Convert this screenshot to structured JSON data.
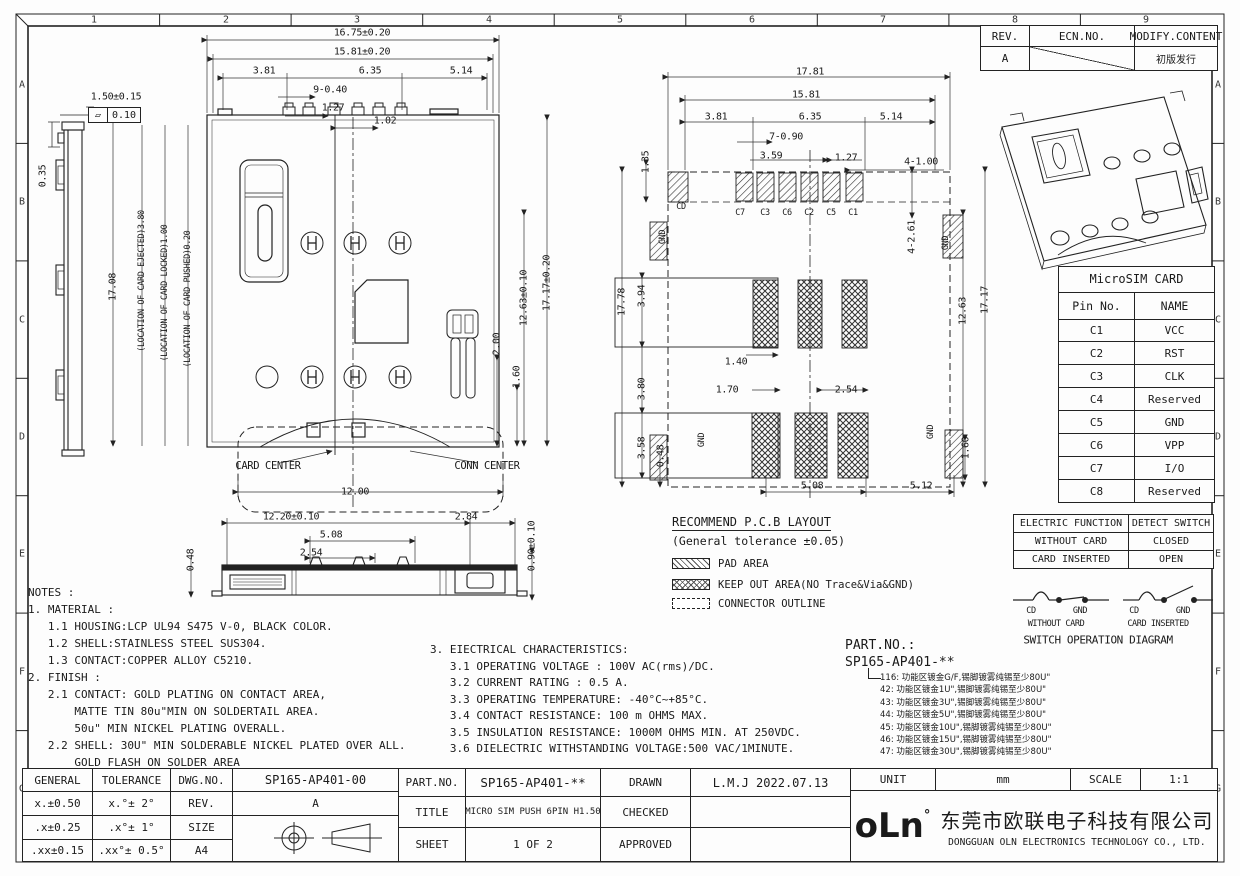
{
  "frame": {
    "columns": [
      "1",
      "2",
      "3",
      "4",
      "5",
      "6",
      "7",
      "8",
      "9"
    ],
    "rows": [
      "A",
      "B",
      "C",
      "D",
      "E",
      "F",
      "G"
    ]
  },
  "revision_table": {
    "rev_header": "REV.",
    "ecn_header": "ECN.NO.",
    "modify_header": "MODIFY.CONTENT",
    "rev": "A",
    "modify": "初版发行"
  },
  "dims": {
    "sv_d1": "1.50±0.15",
    "sv_flat": "0.10",
    "sv_d2": "0.35",
    "tv_w1": "16.75±0.20",
    "tv_w2": "15.81±0.20",
    "tv_w3": "3.81",
    "tv_w4": "6.35",
    "tv_w5": "5.14",
    "tv_pin": "9-0.40",
    "tv_p1": "1.27",
    "tv_p2": "1.02",
    "tv_h": "17.08",
    "tv_loc1": "(LOCATION OF CARD EJECTED)3.80",
    "tv_loc2": "(LOCATION OF CARD LOCKED)1.00",
    "tv_loc3": "(LOCATION OF CARD PUSHED)0.20",
    "tv_h1": "12.63±0.10",
    "tv_h2": "17.17±0.20",
    "tv_d200": "2.00",
    "tv_d160": "1.60",
    "tv_w6": "12.00",
    "cc": "CARD CENTER",
    "conn": "CONN CENTER",
    "bv_w1": "12.20±0.10",
    "bv_w2": "2.84",
    "bv_w3": "5.08",
    "bv_w4": "2.54",
    "bv_h1": "0.48",
    "bv_h2": "0.90±0.10",
    "pcb_w1": "17.81",
    "pcb_w2": "15.81",
    "pcb_w3": "3.81",
    "pcb_w4": "6.35",
    "pcb_w5": "5.14",
    "pcb_pin": "7-0.90",
    "pcb_d359": "3.59",
    "pcb_d127": "1.27",
    "pcb_d100": "4-1.00",
    "pcb_d135": "1.35",
    "pcb_cd": "CD",
    "pcb_c7": "C7",
    "pcb_c3": "C3",
    "pcb_c6": "C6",
    "pcb_c2": "C2",
    "pcb_c5": "C5",
    "pcb_c1": "C1",
    "pcb_gnd1": "GND",
    "pcb_gnd2": "GND",
    "pcb_gnd3": "GND",
    "pcb_gnd4": "GND",
    "pcb_d261": "4-2.61",
    "pcb_h1778": "17.78",
    "pcb_d394": "3.94",
    "pcb_d380": "3.80",
    "pcb_d358": "3.58",
    "pcb_d048": "0.48",
    "pcb_d140": "1.40",
    "pcb_d170": "1.70",
    "pcb_d254": "2.54",
    "pcb_d1263": "12.63",
    "pcb_d1717": "17.17",
    "pcb_d160": "1.60",
    "pcb_d508": "5.08",
    "pcb_d512": "5.12"
  },
  "pcb_legend": {
    "title": "RECOMMEND P.C.B LAYOUT",
    "subtitle": "(General tolerance ±0.05)",
    "pad": "PAD AREA",
    "keepout": "KEEP OUT AREA(NO Trace&Via&GND)",
    "outline": "CONNECTOR OUTLINE"
  },
  "sim_table": {
    "title": "MicroSIM CARD",
    "pin_header": "Pin No.",
    "name_header": "NAME",
    "rows": [
      [
        "C1",
        "VCC"
      ],
      [
        "C2",
        "RST"
      ],
      [
        "C3",
        "CLK"
      ],
      [
        "C4",
        "Reserved"
      ],
      [
        "C5",
        "GND"
      ],
      [
        "C6",
        "VPP"
      ],
      [
        "C7",
        "I/O"
      ],
      [
        "C8",
        "Reserved"
      ]
    ]
  },
  "switch_table": {
    "h1": "ELECTRIC FUNCTION",
    "h2": "DETECT SWITCH",
    "r1c1": "WITHOUT CARD",
    "r1c2": "CLOSED",
    "r2c1": "CARD INSERTED",
    "r2c2": "OPEN"
  },
  "switch_diagram": {
    "cd1": "CD",
    "gnd1": "GND",
    "cd2": "CD",
    "gnd2": "GND",
    "without": "WITHOUT CARD",
    "inserted": "CARD INSERTED",
    "title": "SWITCH OPERATION DIAGRAM"
  },
  "part_options": {
    "label": "PART.NO.:",
    "value": "SP165-AP401-**",
    "options": [
      "116: 功能区镀金G/F,锡脚镀雾纯锡至少80U\"",
      "42: 功能区镀金1U\",锡脚镀雾纯锡至少80U\"",
      "43: 功能区镀金3U\",锡脚镀雾纯锡至少80U\"",
      "44: 功能区镀金5U\",锡脚镀雾纯锡至少80U\"",
      "45: 功能区镀金10U\",锡脚镀雾纯锡至少80U\"",
      "46: 功能区镀金15U\",锡脚镀雾纯锡至少80U\"",
      "47: 功能区镀金30U\",锡脚镀雾纯锡至少80U\""
    ]
  },
  "notes": {
    "lines": [
      "NOTES :",
      "1. MATERIAL :",
      "   1.1 HOUSING:LCP UL94 S475 V-0, BLACK COLOR.",
      "   1.2 SHELL:STAINLESS STEEL SUS304.",
      "   1.3 CONTACT:COPPER ALLOY C5210.",
      "2. FINISH :",
      "   2.1 CONTACT: GOLD PLATING ON CONTACT AREA,",
      "       MATTE TIN 80u\"MIN ON SOLDERTAIL AREA.",
      "       50u\" MIN NICKEL PLATING OVERALL.",
      "   2.2 SHELL: 30U\" MIN SOLDERABLE NICKEL PLATED OVER ALL.",
      "       GOLD FLASH ON SOLDER AREA"
    ]
  },
  "electrical": {
    "lines": [
      "3. EIECTRICAL CHARACTERISTICS:",
      "   3.1 OPERATING VOLTAGE : 100V AC(rms)/DC.",
      "   3.2 CURRENT RATING : 0.5 A.",
      "   3.3 OPERATING TEMPERATURE: -40°C~+85°C.",
      "   3.4 CONTACT RESISTANCE: 100 m OHMS MAX.",
      "   3.5 INSULATION RESISTANCE: 1000M OHMS MIN. AT 250VDC.",
      "   3.6 DIELECTRIC WITHSTANDING VOLTAGE:500 VAC/1MINUTE."
    ]
  },
  "title_block": {
    "general": "GENERAL",
    "tolerance": "TOLERANCE",
    "dwg_no_label": "DWG.NO.",
    "dwg_no": "SP165-AP401-00",
    "tol_rows": [
      [
        "x.±0.50",
        "x.°± 2°"
      ],
      [
        ".x±0.25",
        ".x°± 1°"
      ],
      [
        ".xx±0.15",
        ".xx°± 0.5°"
      ]
    ],
    "rev_label": "REV.",
    "rev": "A",
    "size_label": "SIZE",
    "size": "A4",
    "part_label": "PART.NO.",
    "part_no": "SP165-AP401-**",
    "title_label": "TITLE",
    "title": "MICRO SIM PUSH 6PIN H1.50",
    "sheet_label": "SHEET",
    "sheet": "1 OF 2",
    "drawn_label": "DRAWN",
    "drawn": "L.M.J 2022.07.13",
    "checked_label": "CHECKED",
    "approved_label": "APPROVED",
    "unit_label": "UNIT",
    "unit": "mm",
    "scale_label": "SCALE",
    "scale": "1:1",
    "logo": "oLn",
    "logo_degree": "°",
    "company_cn": "东莞市欧联电子科技有限公司",
    "company_en": "DONGGUAN OLN ELECTRONICS TECHNOLOGY CO., LTD."
  }
}
